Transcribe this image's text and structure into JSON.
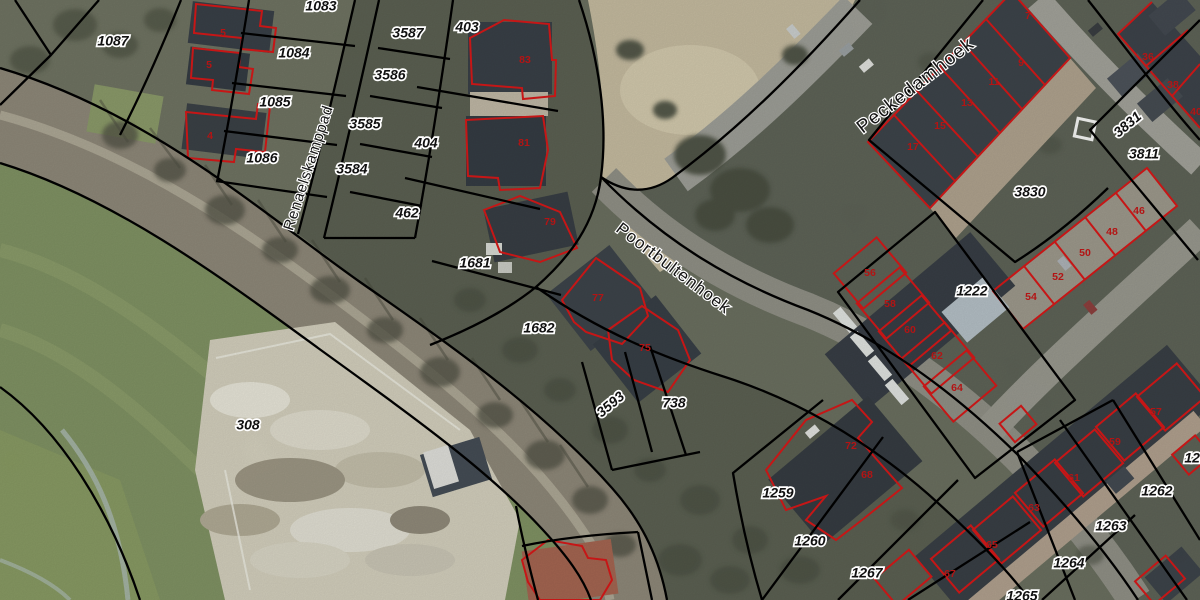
{
  "map": {
    "kind": "cadastral aerial view",
    "colors": {
      "parcel_boundary": "#000000",
      "building_outline": "#c61616",
      "house_number": "#b31414",
      "label_text": "#111111",
      "label_halo": "#ffffff"
    },
    "street_labels": [
      {
        "text": "Peckedamhoek",
        "x": 916,
        "y": 86,
        "rot": -38,
        "size": 19
      },
      {
        "text": "Poortbultenhoek",
        "x": 673,
        "y": 269,
        "rot": 37,
        "size": 17
      },
      {
        "text": "Renaelskamppad",
        "x": 309,
        "y": 168,
        "rot": -72,
        "size": 15
      }
    ],
    "parcel_labels": [
      {
        "text": "1087",
        "x": 113,
        "y": 42,
        "rot": 0
      },
      {
        "text": "1083",
        "x": 321,
        "y": 7,
        "rot": 0
      },
      {
        "text": "1084",
        "x": 294,
        "y": 54,
        "rot": 0
      },
      {
        "text": "1085",
        "x": 275,
        "y": 103,
        "rot": 0
      },
      {
        "text": "1086",
        "x": 262,
        "y": 159,
        "rot": 0
      },
      {
        "text": "3587",
        "x": 408,
        "y": 34,
        "rot": 0
      },
      {
        "text": "3586",
        "x": 390,
        "y": 76,
        "rot": 0
      },
      {
        "text": "3585",
        "x": 365,
        "y": 125,
        "rot": 0
      },
      {
        "text": "3584",
        "x": 352,
        "y": 170,
        "rot": 0
      },
      {
        "text": "403",
        "x": 467,
        "y": 28,
        "rot": 0
      },
      {
        "text": "404",
        "x": 426,
        "y": 144,
        "rot": 0
      },
      {
        "text": "462",
        "x": 407,
        "y": 214,
        "rot": 0
      },
      {
        "text": "1681",
        "x": 475,
        "y": 264,
        "rot": 0
      },
      {
        "text": "1682",
        "x": 539,
        "y": 329,
        "rot": 0
      },
      {
        "text": "3593",
        "x": 611,
        "y": 405,
        "rot": -40
      },
      {
        "text": "738",
        "x": 674,
        "y": 404,
        "rot": 0
      },
      {
        "text": "308",
        "x": 248,
        "y": 426,
        "rot": 0
      },
      {
        "text": "1259",
        "x": 778,
        "y": 494,
        "rot": 0
      },
      {
        "text": "1260",
        "x": 810,
        "y": 542,
        "rot": 0
      },
      {
        "text": "1267",
        "x": 867,
        "y": 574,
        "rot": 0
      },
      {
        "text": "3831",
        "x": 1128,
        "y": 125,
        "rot": -40
      },
      {
        "text": "3811",
        "x": 1144,
        "y": 155,
        "rot": 0
      },
      {
        "text": "3830",
        "x": 1030,
        "y": 193,
        "rot": 0
      },
      {
        "text": "1222",
        "x": 972,
        "y": 292,
        "rot": 0
      },
      {
        "text": "126",
        "x": 1196,
        "y": 459,
        "rot": 0
      },
      {
        "text": "1262",
        "x": 1157,
        "y": 492,
        "rot": 0
      },
      {
        "text": "1263",
        "x": 1111,
        "y": 527,
        "rot": 0
      },
      {
        "text": "1264",
        "x": 1069,
        "y": 564,
        "rot": 0
      },
      {
        "text": "1265",
        "x": 1022,
        "y": 597,
        "rot": 0
      }
    ],
    "house_numbers": [
      {
        "text": "5",
        "x": 223,
        "y": 33
      },
      {
        "text": "5",
        "x": 209,
        "y": 65
      },
      {
        "text": "4",
        "x": 210,
        "y": 136
      },
      {
        "text": "83",
        "x": 525,
        "y": 60
      },
      {
        "text": "81",
        "x": 524,
        "y": 143
      },
      {
        "text": "79",
        "x": 550,
        "y": 222
      },
      {
        "text": "77",
        "x": 598,
        "y": 298
      },
      {
        "text": "75",
        "x": 645,
        "y": 348
      },
      {
        "text": "72",
        "x": 851,
        "y": 446
      },
      {
        "text": "68",
        "x": 867,
        "y": 475
      },
      {
        "text": "7",
        "x": 1028,
        "y": 16
      },
      {
        "text": "9",
        "x": 1021,
        "y": 63
      },
      {
        "text": "11",
        "x": 994,
        "y": 82
      },
      {
        "text": "13",
        "x": 967,
        "y": 103
      },
      {
        "text": "15",
        "x": 940,
        "y": 126
      },
      {
        "text": "17",
        "x": 913,
        "y": 147
      },
      {
        "text": "36",
        "x": 1148,
        "y": 57
      },
      {
        "text": "38",
        "x": 1173,
        "y": 85
      },
      {
        "text": "40",
        "x": 1196,
        "y": 112
      },
      {
        "text": "46",
        "x": 1139,
        "y": 211
      },
      {
        "text": "48",
        "x": 1112,
        "y": 232
      },
      {
        "text": "50",
        "x": 1085,
        "y": 253
      },
      {
        "text": "52",
        "x": 1058,
        "y": 277
      },
      {
        "text": "54",
        "x": 1031,
        "y": 297
      },
      {
        "text": "56",
        "x": 870,
        "y": 273
      },
      {
        "text": "58",
        "x": 890,
        "y": 304
      },
      {
        "text": "60",
        "x": 910,
        "y": 330
      },
      {
        "text": "62",
        "x": 937,
        "y": 356
      },
      {
        "text": "64",
        "x": 957,
        "y": 388
      },
      {
        "text": "57",
        "x": 1156,
        "y": 412
      },
      {
        "text": "59",
        "x": 1115,
        "y": 442
      },
      {
        "text": "61",
        "x": 1074,
        "y": 478
      },
      {
        "text": "63",
        "x": 1034,
        "y": 508
      },
      {
        "text": "65",
        "x": 992,
        "y": 545
      },
      {
        "text": "67",
        "x": 950,
        "y": 574
      }
    ]
  }
}
